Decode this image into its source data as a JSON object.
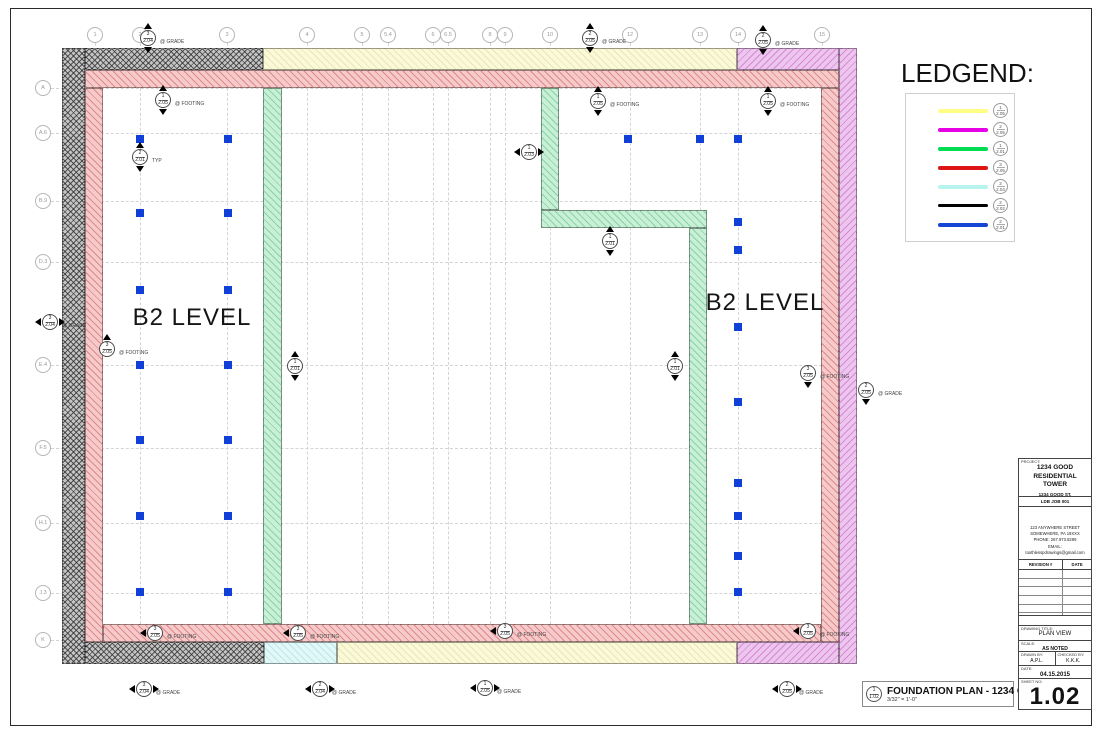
{
  "colors": {
    "wall_gray": "#c4c4c4",
    "wall_pink": "#f6caca",
    "wall_yellow": "#fbfad8",
    "wall_magenta": "#edc6ed",
    "wall_green": "#c9efd6",
    "wall_cyan": "#e2f7f7",
    "footing_blue": "#1040d8"
  },
  "legend": {
    "title": "LEDGEND:",
    "items": [
      {
        "name": "yellow-wall",
        "color": "#ffff85",
        "top": "1",
        "bottom": "2.05"
      },
      {
        "name": "magenta-wall",
        "color": "#e600e6",
        "top": "2",
        "bottom": "2.05"
      },
      {
        "name": "green-wall",
        "color": "#00dd55",
        "top": "1",
        "bottom": "2.01"
      },
      {
        "name": "red-wall",
        "color": "#dd1515",
        "top": "3",
        "bottom": "2.05"
      },
      {
        "name": "cyan-wall",
        "color": "#b8f4ee",
        "top": "2",
        "bottom": "2.04"
      },
      {
        "name": "black-wall",
        "color": "#000000",
        "top": "2",
        "bottom": "2.02"
      },
      {
        "name": "blue-footing",
        "color": "#1545d5",
        "top": "2",
        "bottom": "2.01"
      }
    ]
  },
  "grid": {
    "cols": [
      {
        "label": "1",
        "x": 95
      },
      {
        "label": "2",
        "x": 140
      },
      {
        "label": "3",
        "x": 227
      },
      {
        "label": "4",
        "x": 307
      },
      {
        "label": "5",
        "x": 362
      },
      {
        "label": "5.4",
        "x": 388
      },
      {
        "label": "6",
        "x": 433
      },
      {
        "label": "6.5",
        "x": 448
      },
      {
        "label": "8",
        "x": 490
      },
      {
        "label": "9",
        "x": 505
      },
      {
        "label": "10",
        "x": 550
      },
      {
        "label": "12",
        "x": 630
      },
      {
        "label": "13",
        "x": 700
      },
      {
        "label": "14",
        "x": 738
      },
      {
        "label": "15",
        "x": 822
      }
    ],
    "rows": [
      {
        "label": "A",
        "y": 88
      },
      {
        "label": "A.6",
        "y": 133
      },
      {
        "label": "B.9",
        "y": 201
      },
      {
        "label": "D.3",
        "y": 262
      },
      {
        "label": "E.4",
        "y": 365
      },
      {
        "label": "F.5",
        "y": 448
      },
      {
        "label": "H.1",
        "y": 523
      },
      {
        "label": "J.3",
        "y": 593
      },
      {
        "label": "K",
        "y": 640
      }
    ]
  },
  "plan": {
    "b2_left": "B2 LEVEL",
    "b2_right": "B2 LEVEL",
    "footings": [
      [
        140,
        139
      ],
      [
        228,
        139
      ],
      [
        140,
        213
      ],
      [
        228,
        213
      ],
      [
        140,
        290
      ],
      [
        228,
        290
      ],
      [
        140,
        365
      ],
      [
        228,
        365
      ],
      [
        140,
        440
      ],
      [
        228,
        440
      ],
      [
        140,
        516
      ],
      [
        228,
        516
      ],
      [
        140,
        592
      ],
      [
        228,
        592
      ],
      [
        628,
        139
      ],
      [
        700,
        139
      ],
      [
        738,
        139
      ],
      [
        738,
        222
      ],
      [
        738,
        250
      ],
      [
        738,
        327
      ],
      [
        738,
        402
      ],
      [
        738,
        483
      ],
      [
        738,
        516
      ],
      [
        738,
        556
      ],
      [
        738,
        592
      ]
    ],
    "markers": [
      {
        "x": 148,
        "y": 38,
        "top": "3",
        "bot": "2.04",
        "label": "@ GRADE",
        "dir": "ud"
      },
      {
        "x": 590,
        "y": 38,
        "top": "2",
        "bot": "2.05",
        "label": "@ GRADE",
        "dir": "ud"
      },
      {
        "x": 763,
        "y": 40,
        "top": "2",
        "bot": "2.05",
        "label": "@ GRADE",
        "dir": "ud"
      },
      {
        "x": 163,
        "y": 100,
        "top": "1",
        "bot": "2.05",
        "label": "@ FOOTING",
        "dir": "ud"
      },
      {
        "x": 598,
        "y": 101,
        "top": "1",
        "bot": "2.05",
        "label": "@ FOOTING",
        "dir": "ud"
      },
      {
        "x": 768,
        "y": 101,
        "top": "1",
        "bot": "2.05",
        "label": "@ FOOTING",
        "dir": "ud"
      },
      {
        "x": 140,
        "y": 157,
        "top": "2",
        "bot": "2.01",
        "label": "TYP",
        "dir": "ud"
      },
      {
        "x": 529,
        "y": 152,
        "top": "1",
        "bot": "2.03",
        "label": "",
        "dir": "lr"
      },
      {
        "x": 50,
        "y": 322,
        "top": "3",
        "bot": "2.04",
        "label": "@ GRADE",
        "dir": "lr"
      },
      {
        "x": 107,
        "y": 349,
        "top": "3",
        "bot": "2.05",
        "label": "@ FOOTING",
        "dir": "u"
      },
      {
        "x": 295,
        "y": 366,
        "top": "1",
        "bot": "2.01",
        "label": "",
        "dir": "ud"
      },
      {
        "x": 610,
        "y": 241,
        "top": "1",
        "bot": "2.01",
        "label": "",
        "dir": "ud"
      },
      {
        "x": 675,
        "y": 366,
        "top": "1",
        "bot": "2.01",
        "label": "",
        "dir": "ud"
      },
      {
        "x": 808,
        "y": 373,
        "top": "3",
        "bot": "2.05",
        "label": "@ FOOTING",
        "dir": "d"
      },
      {
        "x": 866,
        "y": 390,
        "top": "2",
        "bot": "2.05",
        "label": "@ GRADE",
        "dir": "d"
      },
      {
        "x": 155,
        "y": 633,
        "top": "3",
        "bot": "2.05",
        "label": "@ FOOTING",
        "dir": "l"
      },
      {
        "x": 298,
        "y": 633,
        "top": "3",
        "bot": "2.05",
        "label": "@ FOOTING",
        "dir": "l"
      },
      {
        "x": 505,
        "y": 631,
        "top": "3",
        "bot": "2.05",
        "label": "@ FOOTING",
        "dir": "l"
      },
      {
        "x": 808,
        "y": 631,
        "top": "3",
        "bot": "2.05",
        "label": "@ FOOTING",
        "dir": "l"
      },
      {
        "x": 144,
        "y": 689,
        "top": "3",
        "bot": "2.04",
        "label": "@ GRADE",
        "dir": "lr"
      },
      {
        "x": 320,
        "y": 689,
        "top": "2",
        "bot": "2.04",
        "label": "@ GRADE",
        "dir": "lr"
      },
      {
        "x": 485,
        "y": 688,
        "top": "1",
        "bot": "2.05",
        "label": "@ GRADE",
        "dir": "lr"
      },
      {
        "x": 787,
        "y": 689,
        "top": "2",
        "bot": "2.05",
        "label": "@ GRADE",
        "dir": "lr"
      }
    ]
  },
  "title_bar": {
    "circle_top": "1",
    "circle_bottom": "1.02",
    "title": "FOUNDATION PLAN - 1234 GOOD",
    "scale": "3/32\" = 1'-0\"",
    "ref": "Re: 1/S.101"
  },
  "title_block": {
    "project_caption": "PROJECT:",
    "project_l1": "1234 GOOD",
    "project_l2": "RESIDENTIAL TOWER",
    "addr_l1": "1234 GOOD ST,",
    "addr_l2": "PHILADELPHIA, PA",
    "job": "LDB JOB 001",
    "firm_lines": [
      "123 ANYWHERE STREET",
      "SOMEWHERE, PA 19XXX",
      "PHONE: 267.973.8289",
      "EMAIL: toothlesspdrawings@gmail.com"
    ],
    "revision_header": "REVISION #",
    "date_header": "DATE",
    "revision_rows": 6,
    "drawing_title_caption": "DRAWING TITLE:",
    "drawing_title": "PLAN VIEW",
    "scale_caption": "SCALE:",
    "scale": "AS NOTED",
    "drawn_caption": "DRAWN BY:",
    "drawn": "A.P.L.",
    "checked_caption": "CHECKED BY:",
    "checked": "K.K.K.",
    "date_caption": "DATE:",
    "date": "04.15.2015",
    "sheet_caption": "SHEET NO:",
    "sheet_number": "1.02"
  }
}
